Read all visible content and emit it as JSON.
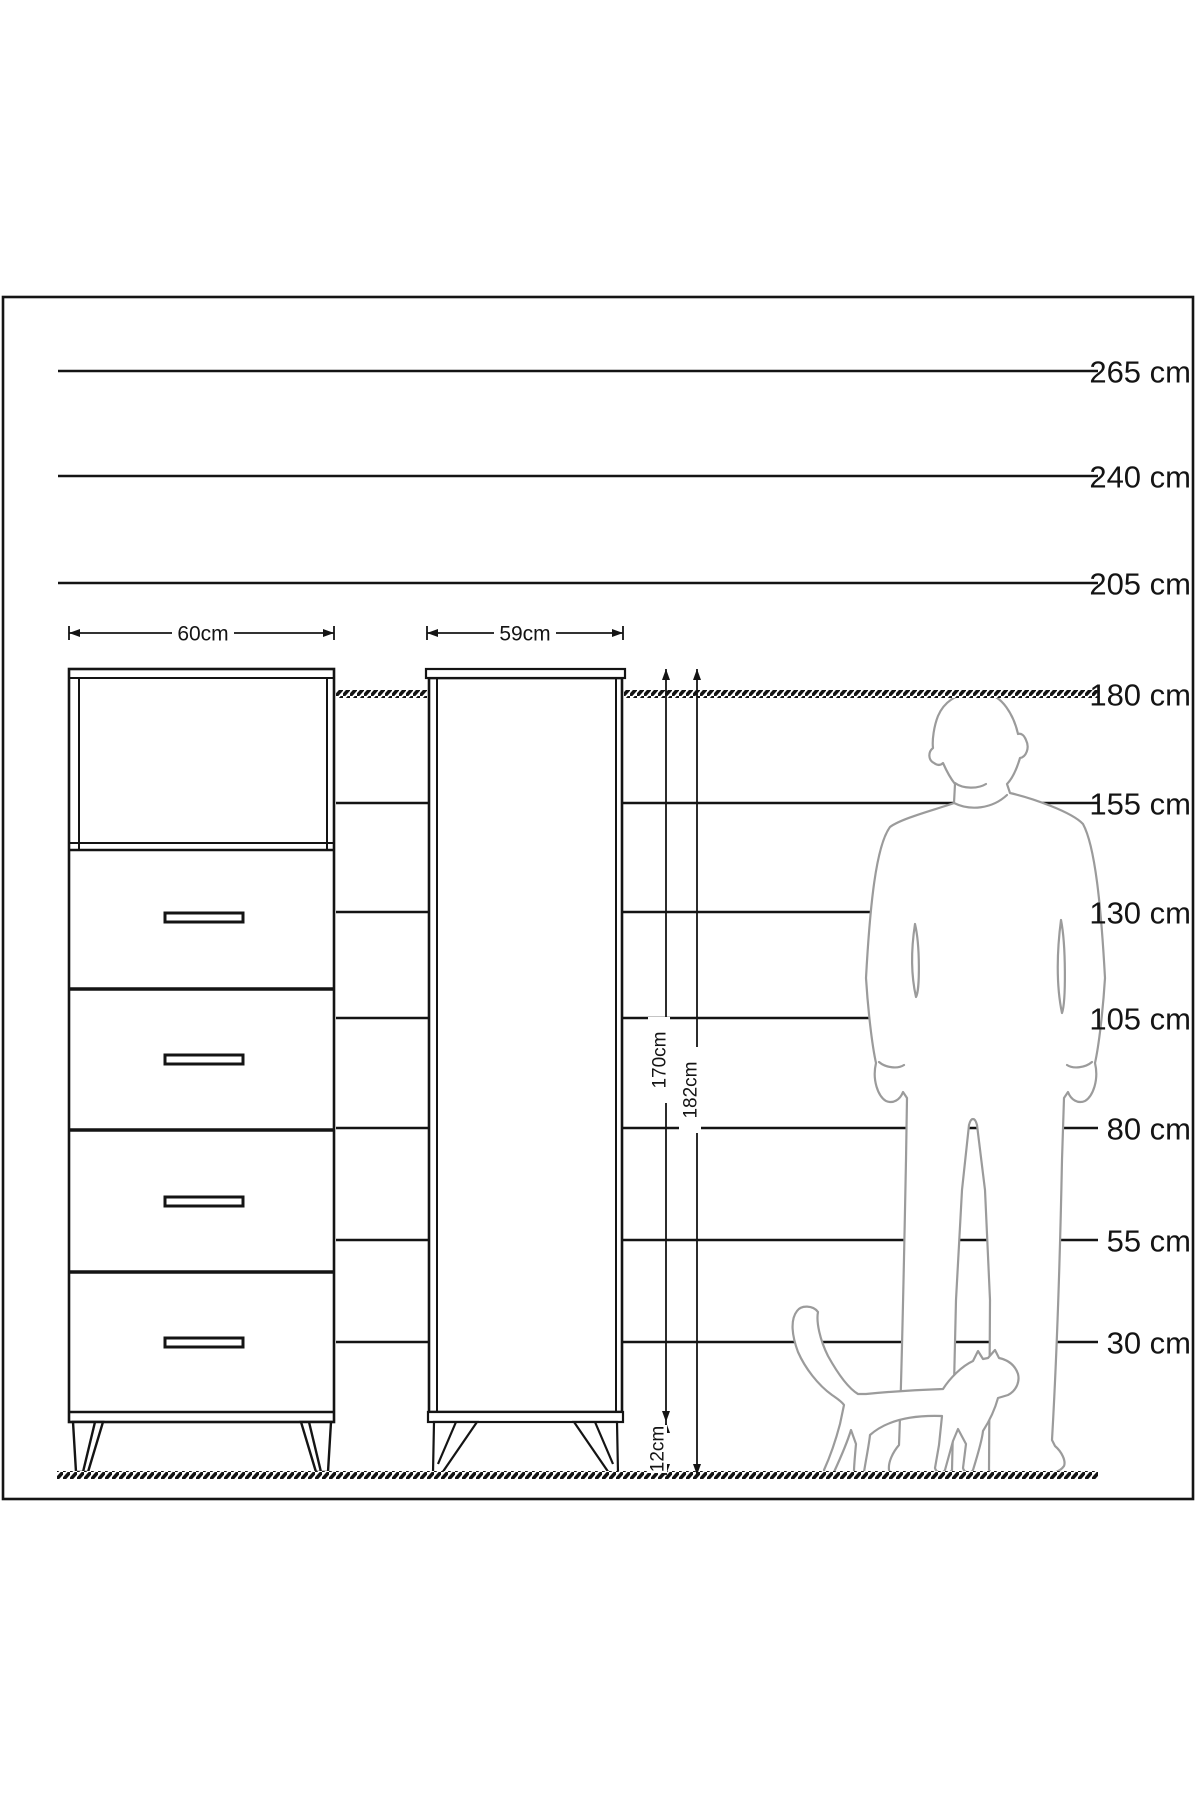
{
  "scale": {
    "labels": [
      "265 cm",
      "240 cm",
      "205 cm",
      "180 cm",
      "155 cm",
      "130 cm",
      "105 cm",
      "80 cm",
      "55 cm",
      "30 cm"
    ]
  },
  "dimensions": {
    "chest_width": "60cm",
    "cabinet_width": "59cm",
    "cabinet_body_height": "170cm",
    "cabinet_total_height": "182cm",
    "leg_height": "12cm"
  }
}
